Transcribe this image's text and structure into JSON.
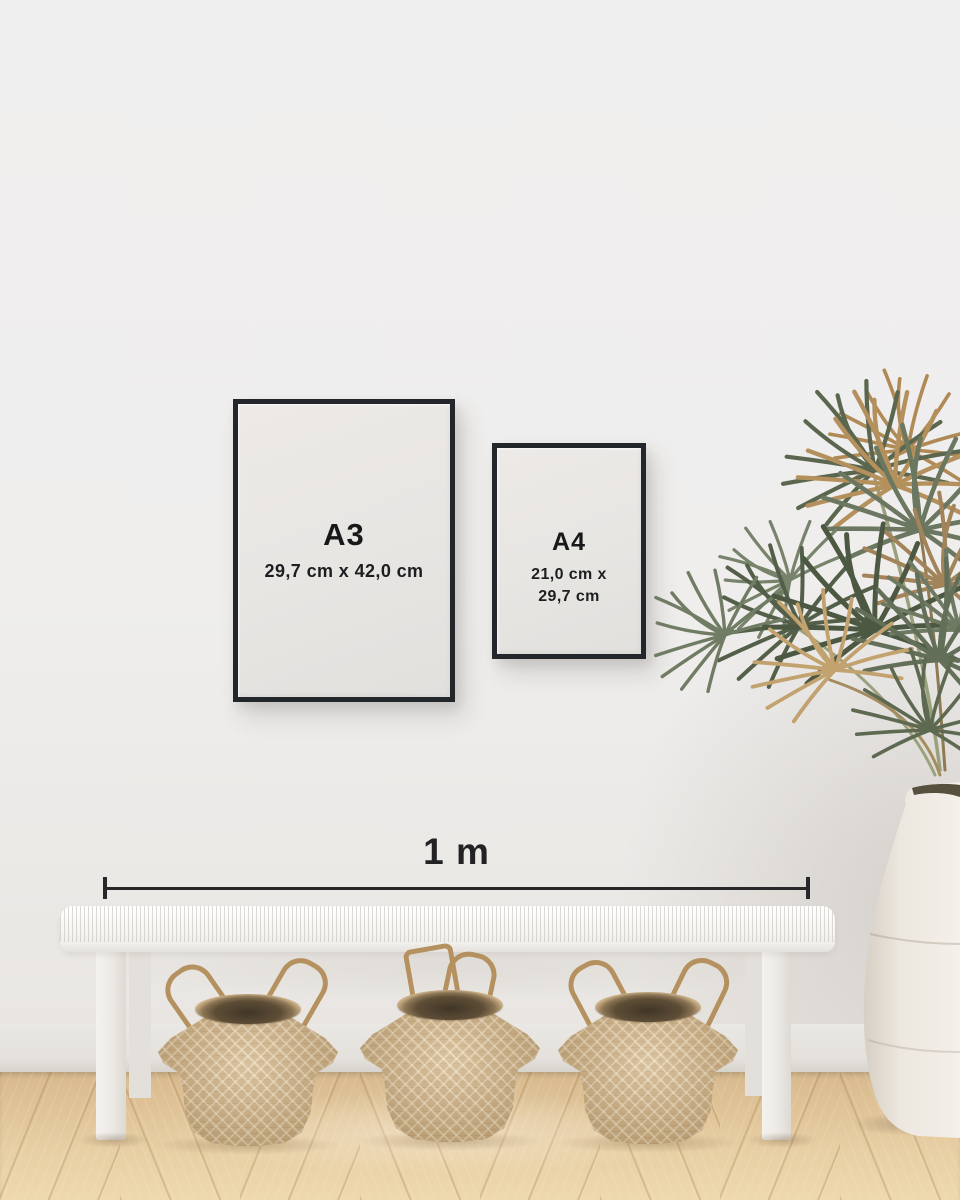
{
  "frames": {
    "a3": {
      "label": "A3",
      "dimensions": "29,7 cm x 42,0 cm"
    },
    "a4": {
      "label": "A4",
      "dimensions_line1": "21,0 cm x",
      "dimensions_line2": "29,7 cm"
    }
  },
  "scale": {
    "label": "1 m"
  },
  "scene": {
    "objects": [
      "a3-poster-frame",
      "a4-poster-frame",
      "scale-bar",
      "white-bench",
      "three-seagrass-baskets",
      "dried-palm-plant",
      "ceramic-floor-vase",
      "wood-floor"
    ],
    "baskets_count": 3
  },
  "palette": {
    "wall": "#efeeed",
    "frame_border": "#23262b",
    "poster_paper": "#e8e6e3",
    "text": "#17181a",
    "scale_line": "#28282b",
    "floor_wood": "#e3c79c",
    "basket_weave": "#c8ab80",
    "basket_handle": "#b5915f",
    "plant_green": "#5c684f",
    "plant_tan": "#b4905c",
    "vase_cream": "#ece7df",
    "bench_white": "#f6f4f1"
  }
}
